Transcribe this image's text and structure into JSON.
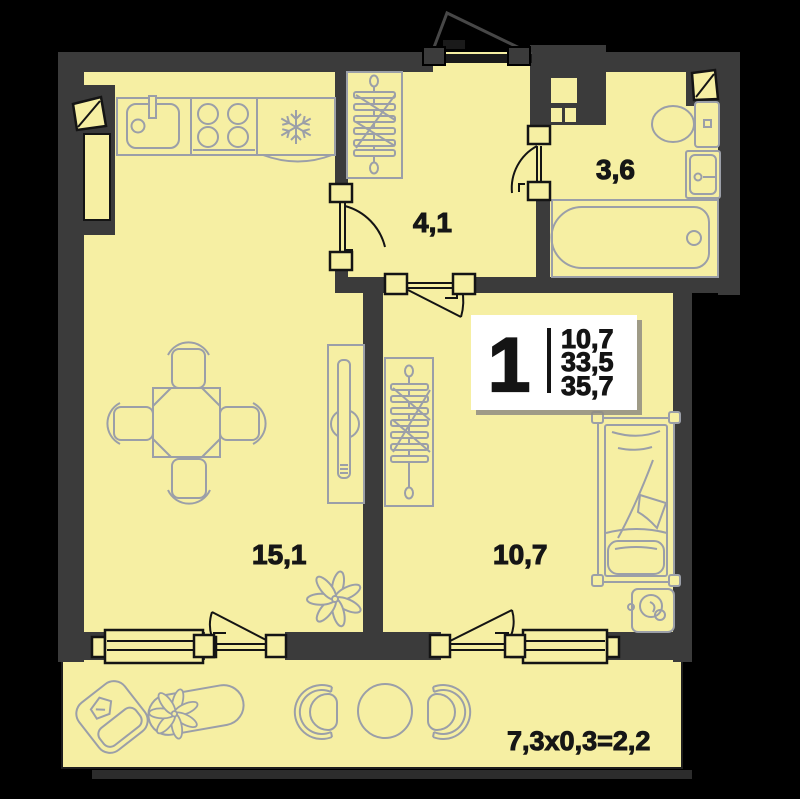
{
  "title": "1-room apartment floor plan",
  "unit": {
    "rooms_count": "1",
    "area_living": "10,7",
    "area_apartment": "33,5",
    "area_total": "35,7"
  },
  "rooms": {
    "kitchen_living": {
      "label": "15,1"
    },
    "hallway": {
      "label": "4,1"
    },
    "bathroom": {
      "label": "3,6"
    },
    "bedroom": {
      "label": "10,7"
    }
  },
  "balcony": {
    "label": "7,3x0,3=2,2"
  },
  "icons": {
    "fridge-icon": "snowflake",
    "stove-icon": "four-burner-circles",
    "kitchen-sink-icon": "basin-with-faucet",
    "wardrobe-icon": "hanger-rail",
    "dining-set-icon": "table-with-4-chairs",
    "tv-console-icon": "narrow-console-with-tv",
    "plant-icon": "petal-flower",
    "toilet-icon": "bowl-with-tank",
    "bath-sink-icon": "washbasin",
    "bathtub-icon": "tub-with-drain",
    "bed-icon": "single-bed-pillow-blanket",
    "nightstand-icon": "stand-with-plant",
    "armchair-icon": "rotated-armchair",
    "planter-icon": "oval-planter-with-flower",
    "balcony-chair-icon": "round-back-chair",
    "round-table-icon": "circle-table",
    "door-icon": "leaf-with-swing-arc",
    "window-icon": "double-line-frame"
  },
  "colors": {
    "background": "#000000",
    "walls": "#3b3b3b",
    "floor": "#f6efa3",
    "furniture_outline": "#9b9fa8",
    "line_black": "#141414",
    "info_box_bg": "#ffffff",
    "text": "#161616"
  }
}
